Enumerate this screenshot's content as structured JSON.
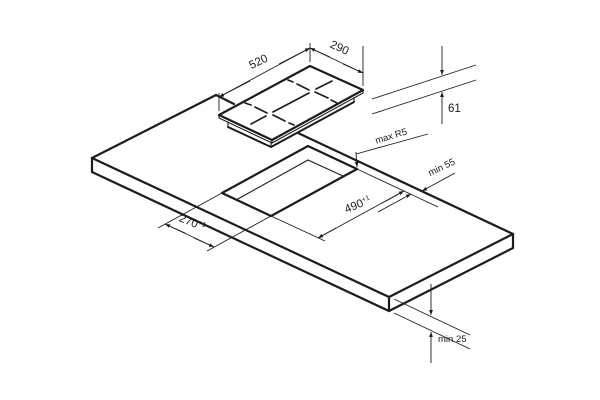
{
  "labels": {
    "hob_width": "520",
    "hob_depth": "290",
    "hob_height": "61",
    "cutout_radius": "max R5",
    "rear_clearance": "min 55",
    "cutout_length": "490",
    "cutout_length_tol": "+1",
    "cutout_width": "270",
    "cutout_width_tol": "+1",
    "worktop_thickness": "min 25"
  },
  "colors": {
    "line": "#1c1c1c",
    "background": "#ffffff"
  }
}
